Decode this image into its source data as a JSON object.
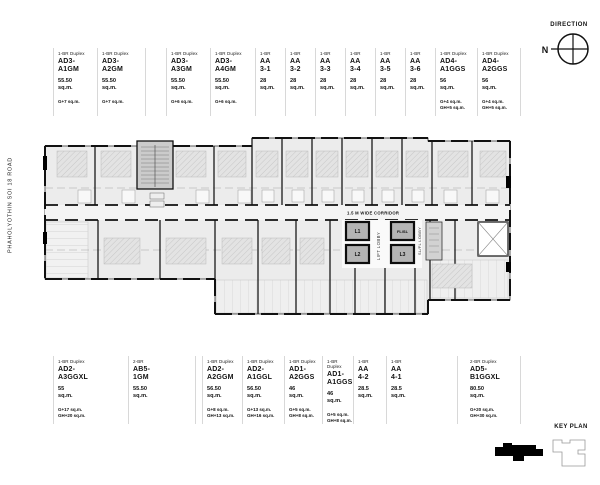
{
  "road_label": "PHAHOLYOTHIN SOI 18 ROAD",
  "direction": {
    "label": "DIRECTION",
    "north_indicator": "N"
  },
  "key_plan": {
    "label": "KEY PLAN"
  },
  "plan": {
    "corridor_label": "1.5 M WIDE CORRIDOR",
    "lift_lobby_label": "LIFT LOBBY",
    "service_lobby_label": "SL/FL LOBBY",
    "lift_1": "L1",
    "lift_2": "L2",
    "lift_3": "L3",
    "fire_lift": "FL/SL"
  },
  "top_units": [
    {
      "type": "1-BR Duplex",
      "name": "AD3-\nA1GM",
      "area": "55.50\nsq.m.",
      "extra": "G+7 sq.m."
    },
    {
      "type": "1-BR Duplex",
      "name": "AD3-\nA2GM",
      "area": "55.50\nsq.m.",
      "extra": "G+7 sq.m."
    },
    {
      "type": "1-BR Duplex",
      "name": "AD3-\nA3GM",
      "area": "55.50\nsq.m.",
      "extra": "G+6 sq.m."
    },
    {
      "type": "1-BR Duplex",
      "name": "AD3-\nA4GM",
      "area": "55.50\nsq.m.",
      "extra": "G+6 sq.m."
    },
    {
      "type": "1-BR",
      "name": "AA\n3-1",
      "area": "28\nsq.m.",
      "extra": ""
    },
    {
      "type": "1-BR",
      "name": "AA\n3-2",
      "area": "28\nsq.m.",
      "extra": ""
    },
    {
      "type": "1-BR",
      "name": "AA\n3-3",
      "area": "28\nsq.m.",
      "extra": ""
    },
    {
      "type": "1-BR",
      "name": "AA\n3-4",
      "area": "28\nsq.m.",
      "extra": ""
    },
    {
      "type": "1-BR",
      "name": "AA\n3-5",
      "area": "28\nsq.m.",
      "extra": ""
    },
    {
      "type": "1-BR",
      "name": "AA\n3-6",
      "area": "28\nsq.m.",
      "extra": ""
    },
    {
      "type": "1-BR Duplex",
      "name": "AD4-\nA1GGS",
      "area": "56\nsq.m.",
      "extra": "G+4 sq.m.\nGH+5 sq.m."
    },
    {
      "type": "1-BR Duplex",
      "name": "AD4-\nA2GGS",
      "area": "56\nsq.m.",
      "extra": "G+4 sq.m.\nGH+5 sq.m."
    }
  ],
  "bottom_units": [
    {
      "type": "1-BR Duplex",
      "name": "AD2-\nA3GGXL",
      "area": "55\nsq.m.",
      "extra": "G+17 sq.m.\nGH+20 sq.m."
    },
    {
      "type": "2-BR",
      "name": "AB5-\n1GM",
      "area": "55.50\nsq.m.",
      "extra": ""
    },
    {
      "type": "1-BR Duplex",
      "name": "AD2-\nA2GGM",
      "area": "56.50\nsq.m.",
      "extra": "G+8 sq.m.\nGH+13 sq.m."
    },
    {
      "type": "1-BR Duplex",
      "name": "AD2-\nA1GGL",
      "area": "56.50\nsq.m.",
      "extra": "G+13 sq.m.\nGH+16 sq.m."
    },
    {
      "type": "1-BR Duplex",
      "name": "AD1-\nA2GGS",
      "area": "46\nsq.m.",
      "extra": "G+5 sq.m.\nGH+8 sq.m."
    },
    {
      "type": "1-BR Duplex",
      "name": "AD1-\nA1GGS",
      "area": "46\nsq.m.",
      "extra": "G+5 sq.m.\nGH+8 sq.m."
    },
    {
      "type": "1-BR",
      "name": "AA\n4-2",
      "area": "28.5\nsq.m.",
      "extra": ""
    },
    {
      "type": "1-BR",
      "name": "AA\n4-1",
      "area": "28.5\nsq.m.",
      "extra": ""
    },
    {
      "type": "2-BR Duplex",
      "name": "AD5-\nB1GGXL",
      "area": "80.50\nsq.m.",
      "extra": "G+20 sq.m.\nGH+30 sq.m."
    }
  ]
}
